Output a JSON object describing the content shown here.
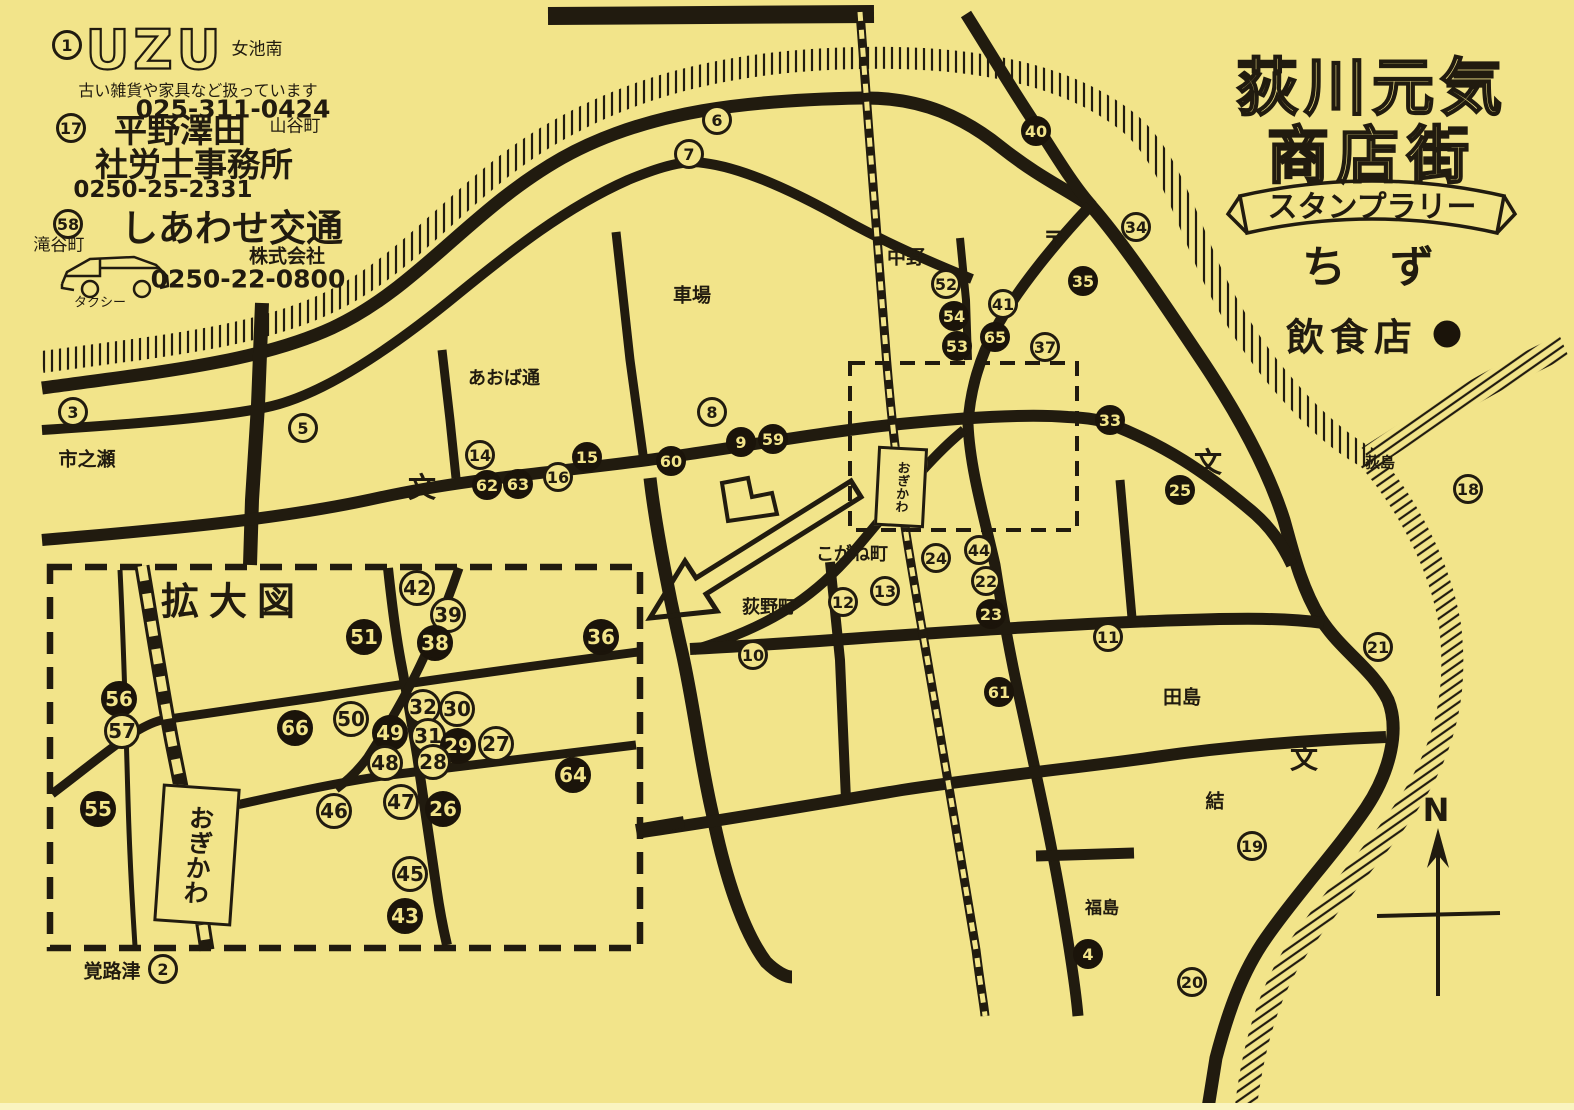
{
  "page": {
    "paper_color": "#f2e48a",
    "ink_color": "#211b0f"
  },
  "title": {
    "line1": "荻川元気",
    "line2": "商店街",
    "banner": "スタンプラリー",
    "map_word": "ち　ず",
    "legend_label": "飲食店"
  },
  "ads": {
    "uzu": {
      "number": 1,
      "logo": "UZU",
      "area": "女池南",
      "desc": "古い雑貨や家具など扱っています",
      "phone": "025-311-0424"
    },
    "hirano": {
      "number": 17,
      "name1": "平野澤田",
      "area": "山谷町",
      "name2": "社労士事務所",
      "phone": "0250-25-2331"
    },
    "shiawase": {
      "number": 58,
      "name": "しあわせ交通",
      "company": "株式会社",
      "phone": "0250-22-0800",
      "area": "滝谷町",
      "vehicle": "タクシー"
    }
  },
  "inset": {
    "label": "拡大図"
  },
  "station": {
    "name": "おぎかわ"
  },
  "compass": {
    "letter": "N"
  },
  "labels": [
    {
      "t": "市之瀬",
      "x": 87,
      "y": 458,
      "s": 19
    },
    {
      "t": "あおば通",
      "x": 504,
      "y": 377,
      "s": 18
    },
    {
      "t": "車場",
      "x": 692,
      "y": 294,
      "s": 19
    },
    {
      "t": "中野",
      "x": 906,
      "y": 256,
      "s": 19
    },
    {
      "t": "〒",
      "x": 1054,
      "y": 238,
      "s": 22,
      "b": 1
    },
    {
      "t": "荻島",
      "x": 1380,
      "y": 462,
      "s": 15
    },
    {
      "t": "こがね町",
      "x": 852,
      "y": 553,
      "s": 18
    },
    {
      "t": "荻野町",
      "x": 769,
      "y": 606,
      "s": 18
    },
    {
      "t": "田島",
      "x": 1182,
      "y": 696,
      "s": 19
    },
    {
      "t": "結",
      "x": 1215,
      "y": 800,
      "s": 19
    },
    {
      "t": "福島",
      "x": 1102,
      "y": 906,
      "s": 17
    },
    {
      "t": "覚路津",
      "x": 112,
      "y": 970,
      "s": 19
    },
    {
      "t": "文",
      "x": 422,
      "y": 486,
      "s": 28,
      "b": 1
    },
    {
      "t": "文",
      "x": 1208,
      "y": 461,
      "s": 28,
      "b": 1
    },
    {
      "t": "文",
      "x": 1304,
      "y": 757,
      "s": 28,
      "b": 1
    }
  ],
  "markers_main": [
    {
      "n": 1,
      "x": 67,
      "y": 45,
      "f": 0
    },
    {
      "n": 17,
      "x": 71,
      "y": 128,
      "f": 0
    },
    {
      "n": 58,
      "x": 68,
      "y": 224,
      "f": 0
    },
    {
      "n": 3,
      "x": 73,
      "y": 412,
      "f": 0
    },
    {
      "n": 5,
      "x": 303,
      "y": 428,
      "f": 0
    },
    {
      "n": 6,
      "x": 717,
      "y": 120,
      "f": 0
    },
    {
      "n": 7,
      "x": 689,
      "y": 154,
      "f": 0
    },
    {
      "n": 8,
      "x": 712,
      "y": 412,
      "f": 0
    },
    {
      "n": 40,
      "x": 1036,
      "y": 131,
      "f": 1
    },
    {
      "n": 34,
      "x": 1136,
      "y": 227,
      "f": 0
    },
    {
      "n": 35,
      "x": 1083,
      "y": 281,
      "f": 1
    },
    {
      "n": 52,
      "x": 946,
      "y": 284,
      "f": 0
    },
    {
      "n": 54,
      "x": 954,
      "y": 316,
      "f": 1
    },
    {
      "n": 53,
      "x": 957,
      "y": 346,
      "f": 1
    },
    {
      "n": 41,
      "x": 1003,
      "y": 304,
      "f": 0
    },
    {
      "n": 65,
      "x": 995,
      "y": 337,
      "f": 1
    },
    {
      "n": 37,
      "x": 1045,
      "y": 347,
      "f": 0
    },
    {
      "n": 14,
      "x": 480,
      "y": 455,
      "f": 0
    },
    {
      "n": 62,
      "x": 487,
      "y": 485,
      "f": 1
    },
    {
      "n": 63,
      "x": 518,
      "y": 484,
      "f": 1
    },
    {
      "n": 16,
      "x": 558,
      "y": 477,
      "f": 0
    },
    {
      "n": 15,
      "x": 587,
      "y": 457,
      "f": 1
    },
    {
      "n": 60,
      "x": 671,
      "y": 461,
      "f": 1
    },
    {
      "n": 9,
      "x": 741,
      "y": 442,
      "f": 1
    },
    {
      "n": 59,
      "x": 773,
      "y": 439,
      "f": 1
    },
    {
      "n": 33,
      "x": 1110,
      "y": 420,
      "f": 1
    },
    {
      "n": 25,
      "x": 1180,
      "y": 490,
      "f": 1
    },
    {
      "n": 18,
      "x": 1468,
      "y": 489,
      "f": 0
    },
    {
      "n": 24,
      "x": 936,
      "y": 558,
      "f": 0
    },
    {
      "n": 44,
      "x": 979,
      "y": 550,
      "f": 0
    },
    {
      "n": 22,
      "x": 986,
      "y": 581,
      "f": 0
    },
    {
      "n": 23,
      "x": 991,
      "y": 614,
      "f": 1
    },
    {
      "n": 13,
      "x": 885,
      "y": 591,
      "f": 0
    },
    {
      "n": 12,
      "x": 843,
      "y": 602,
      "f": 0
    },
    {
      "n": 10,
      "x": 753,
      "y": 655,
      "f": 0
    },
    {
      "n": 11,
      "x": 1108,
      "y": 637,
      "f": 0
    },
    {
      "n": 61,
      "x": 999,
      "y": 692,
      "f": 1
    },
    {
      "n": 21,
      "x": 1378,
      "y": 647,
      "f": 0
    },
    {
      "n": 19,
      "x": 1252,
      "y": 846,
      "f": 0
    },
    {
      "n": 20,
      "x": 1192,
      "y": 982,
      "f": 0
    },
    {
      "n": 4,
      "x": 1088,
      "y": 954,
      "f": 1
    },
    {
      "n": 2,
      "x": 163,
      "y": 969,
      "f": 0
    }
  ],
  "markers_zoom": [
    {
      "n": 42,
      "x": 417,
      "y": 588,
      "f": 0
    },
    {
      "n": 39,
      "x": 448,
      "y": 615,
      "f": 0
    },
    {
      "n": 51,
      "x": 364,
      "y": 637,
      "f": 1
    },
    {
      "n": 38,
      "x": 435,
      "y": 643,
      "f": 1
    },
    {
      "n": 36,
      "x": 601,
      "y": 637,
      "f": 1
    },
    {
      "n": 56,
      "x": 119,
      "y": 699,
      "f": 1
    },
    {
      "n": 57,
      "x": 122,
      "y": 731,
      "f": 0
    },
    {
      "n": 66,
      "x": 295,
      "y": 728,
      "f": 1
    },
    {
      "n": 50,
      "x": 351,
      "y": 719,
      "f": 0
    },
    {
      "n": 49,
      "x": 390,
      "y": 733,
      "f": 1
    },
    {
      "n": 32,
      "x": 423,
      "y": 707,
      "f": 0
    },
    {
      "n": 30,
      "x": 457,
      "y": 709,
      "f": 0
    },
    {
      "n": 31,
      "x": 428,
      "y": 736,
      "f": 0
    },
    {
      "n": 29,
      "x": 458,
      "y": 746,
      "f": 1
    },
    {
      "n": 27,
      "x": 496,
      "y": 744,
      "f": 0
    },
    {
      "n": 48,
      "x": 385,
      "y": 763,
      "f": 0
    },
    {
      "n": 28,
      "x": 433,
      "y": 762,
      "f": 0
    },
    {
      "n": 64,
      "x": 573,
      "y": 775,
      "f": 1
    },
    {
      "n": 55,
      "x": 98,
      "y": 809,
      "f": 1
    },
    {
      "n": 46,
      "x": 334,
      "y": 811,
      "f": 0
    },
    {
      "n": 47,
      "x": 401,
      "y": 802,
      "f": 0
    },
    {
      "n": 26,
      "x": 443,
      "y": 809,
      "f": 1
    },
    {
      "n": 45,
      "x": 410,
      "y": 874,
      "f": 0
    },
    {
      "n": 43,
      "x": 405,
      "y": 916,
      "f": 1
    }
  ]
}
